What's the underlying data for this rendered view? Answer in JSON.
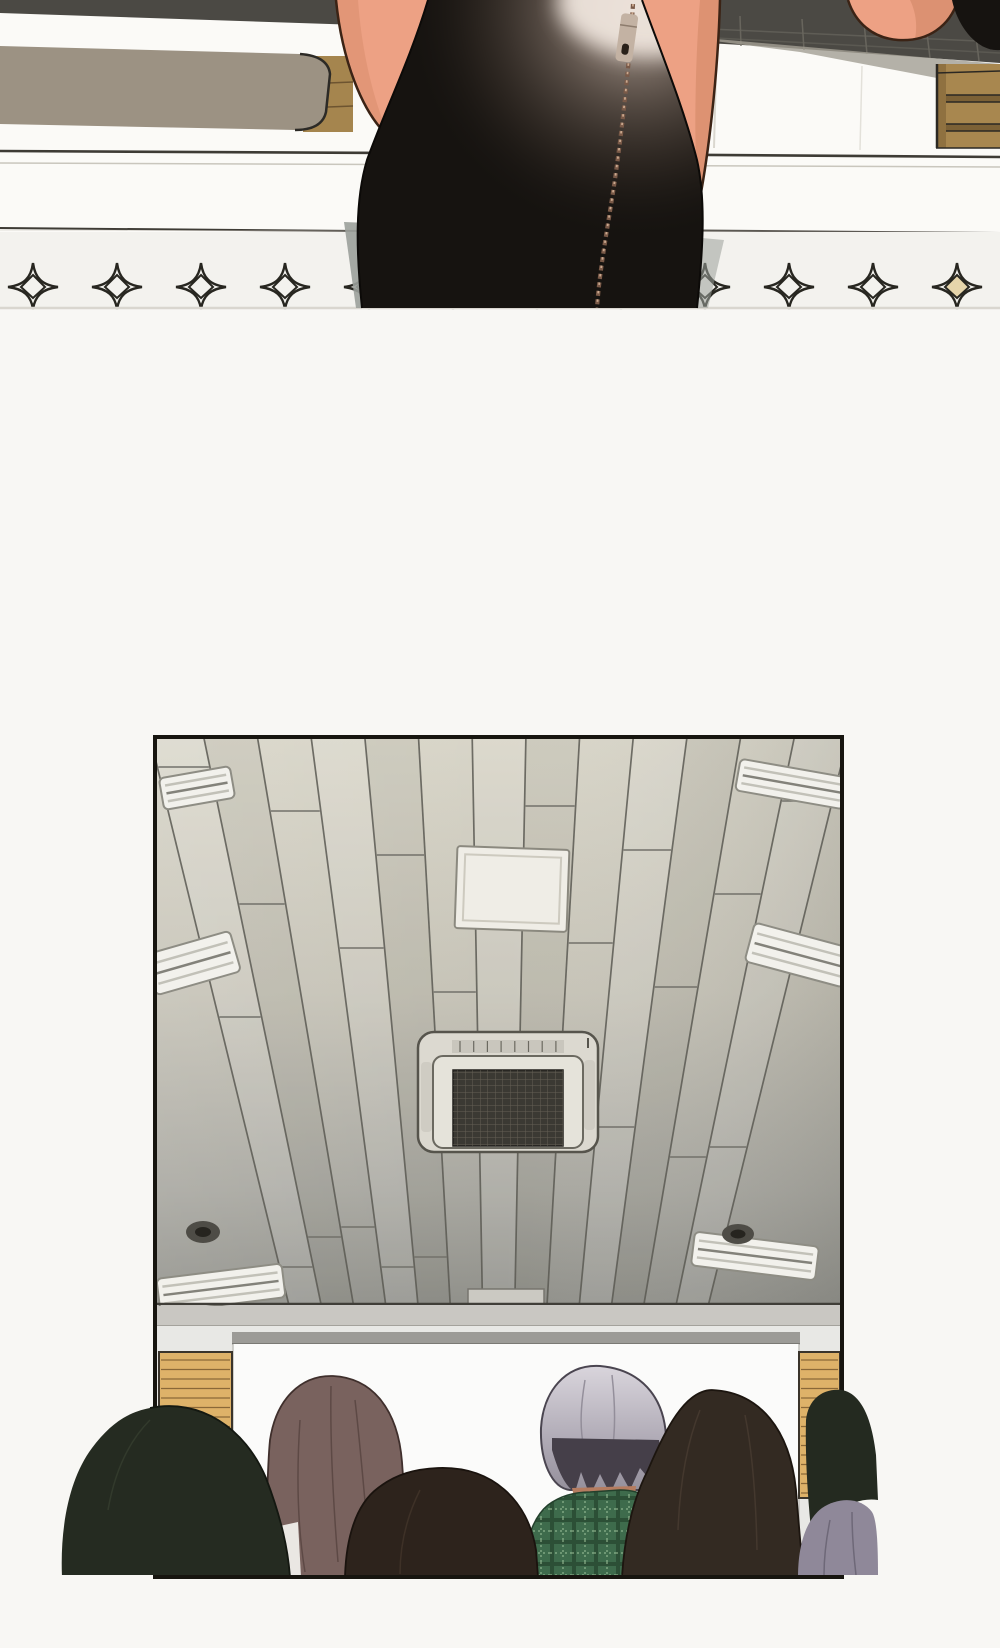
{
  "page": {
    "kind": "webtoon-comic-page",
    "bg": "#f8f7f4",
    "width": 1000,
    "height": 1648
  },
  "panel_top": {
    "label": "skirt-closeup-panel",
    "colors": {
      "bg": "#fbfaf7",
      "band_dark": "#4b4944",
      "band_line": "#6e6b62",
      "shadow_wedge": "#a39f94",
      "shelf": "#9c9283",
      "shelf_outline": "#2c2a26",
      "wood": "#a5854e",
      "wood_line": "#6d5430",
      "wood_outline": "#2e2b26",
      "cabinet": "#a8874f",
      "cabinet_dark": "#8f7140",
      "cabinet_divider": "#7c6136",
      "cabinet_outline": "#2b2823",
      "counter_line_dark": "#3e3b35",
      "counter_line_light": "#c9c6bd",
      "counter_seam": "#dad7cf",
      "strip_bg": "#f3f2ee",
      "strip_edge": "#d9d6cf",
      "skin": "#eda184",
      "skin_shadow": "#d88e6e",
      "skin_outline": "#3b2315",
      "skirt": "#161310",
      "skirt_outline": "#0c0a08",
      "glow_warm": "#d6c4b8",
      "glow_hot": "#eee4dc",
      "zipper_teeth": "#7a5a48",
      "zipper_teeth_light": "#caa88e",
      "zipper_pull": "#c3b2a3",
      "zipper_pull_outline": "#35291f",
      "zipper_hole": "#2a211a",
      "skirt_shadow_grey": "#9ba09a"
    },
    "sparkles": {
      "y": 287,
      "xs": [
        33,
        117,
        201,
        285,
        369,
        453,
        537,
        621,
        705,
        789,
        873,
        957
      ],
      "accent_indices": [
        4,
        11
      ],
      "stroke": "#272620",
      "accent_fill": "#e6d5ab"
    }
  },
  "panel_bottom": {
    "label": "classroom-ceiling-panel",
    "frame": {
      "x": 155,
      "y": 737,
      "w": 687,
      "h": 840,
      "border": "#17150f"
    },
    "ceiling": {
      "vp_x": 498,
      "vp_y": 2160,
      "top_y": 737,
      "edge_y": 1304,
      "left_x": 150,
      "spacing": 53.7,
      "plank_count": 14,
      "line_color": "#5b5a53",
      "seam_color": "#72716a",
      "grad_top": "#d8d5c8",
      "grad_mid": "#c6c3b7",
      "grad_low": "#a8a7a0",
      "grad_bottom": "#90908a",
      "edge_line": "#403e38"
    },
    "light_colors": {
      "fill": "#f2f1ec",
      "stroke": "#8e8d84",
      "ridge": "#c2c1b8",
      "ridge_dark": "#83827a"
    },
    "lights": [
      {
        "cx": 197,
        "cy": 788,
        "w": 72,
        "h": 32,
        "rot": -10
      },
      {
        "cx": 193,
        "cy": 963,
        "w": 88,
        "h": 42,
        "rot": -16
      },
      {
        "cx": 221,
        "cy": 1288,
        "w": 126,
        "h": 34,
        "rot": -7
      },
      {
        "cx": 792,
        "cy": 784,
        "w": 110,
        "h": 32,
        "rot": 10
      },
      {
        "cx": 799,
        "cy": 955,
        "w": 102,
        "h": 40,
        "rot": 15
      },
      {
        "cx": 755,
        "cy": 1256,
        "w": 125,
        "h": 34,
        "rot": 7
      }
    ],
    "access_panel": {
      "fill": "#efede6",
      "stroke": "#8b897f",
      "inner": "#cdcabf"
    },
    "ac": {
      "body": "#dcd9d0",
      "inner": "#e5e3da",
      "frame_line": "#6b6960",
      "outline": "#56544c",
      "vent": "#c9c6bd",
      "mesh_bg": "#3b3933",
      "mesh_line": "#6e6a5e",
      "flap": "#cfccc3"
    },
    "speaker": {
      "fill": "#4e4c46",
      "inner": "#26241f",
      "stroke": "#2e2c28"
    },
    "wall": {
      "molding": "#c9c7c2",
      "molding_line": "#98968f",
      "wall": "#e8e8e5",
      "tab": "#cbc9c2",
      "screen_bar": "#9c9b97",
      "screen_bar_line": "#6f6e69",
      "screen": "#fbfbfa",
      "screen_edge": "#c2c1bd",
      "wood": "#deb269",
      "wood_line": "#8a6838",
      "wood_outline": "#3a342b"
    },
    "wood_panels": [
      {
        "x": 159,
        "y": 1352,
        "w": 73,
        "h": 146
      },
      {
        "x": 799,
        "y": 1352,
        "w": 41,
        "h": 146
      }
    ],
    "audience": {
      "head_left_edge": {
        "hair": "#252b21",
        "outline": "#141811",
        "sheen": "#3c4434"
      },
      "head_longhair": {
        "hair": "#79625e",
        "outline": "#3f2f2c",
        "strand": "#574340",
        "collar": "#eae7e3"
      },
      "head_center": {
        "hair": "#2d231c",
        "outline": "#1a130e",
        "sheen": "#4a3a2e"
      },
      "old_man": {
        "hair_top": "#d9d5dc",
        "hair_mid": "#b2adb8",
        "hair_low": "#948f9b",
        "outline": "#4a4550",
        "streak": "#8f8a96",
        "nape": "#453f49",
        "neck": "#b57c60",
        "neck_line": "#6e4530",
        "plaid_base": "#3e6b4c",
        "plaid_dark": "#2c4f36",
        "plaid_light": "#9fc39b",
        "plaid_outline": "#23402c"
      },
      "head_right": {
        "hair": "#332a22",
        "outline": "#1c150f",
        "sheen": "#55463a"
      },
      "head_right_edge": {
        "hair": "#242a20",
        "clothes": "#8f8899",
        "clothes_line": "#6e6878"
      }
    }
  }
}
